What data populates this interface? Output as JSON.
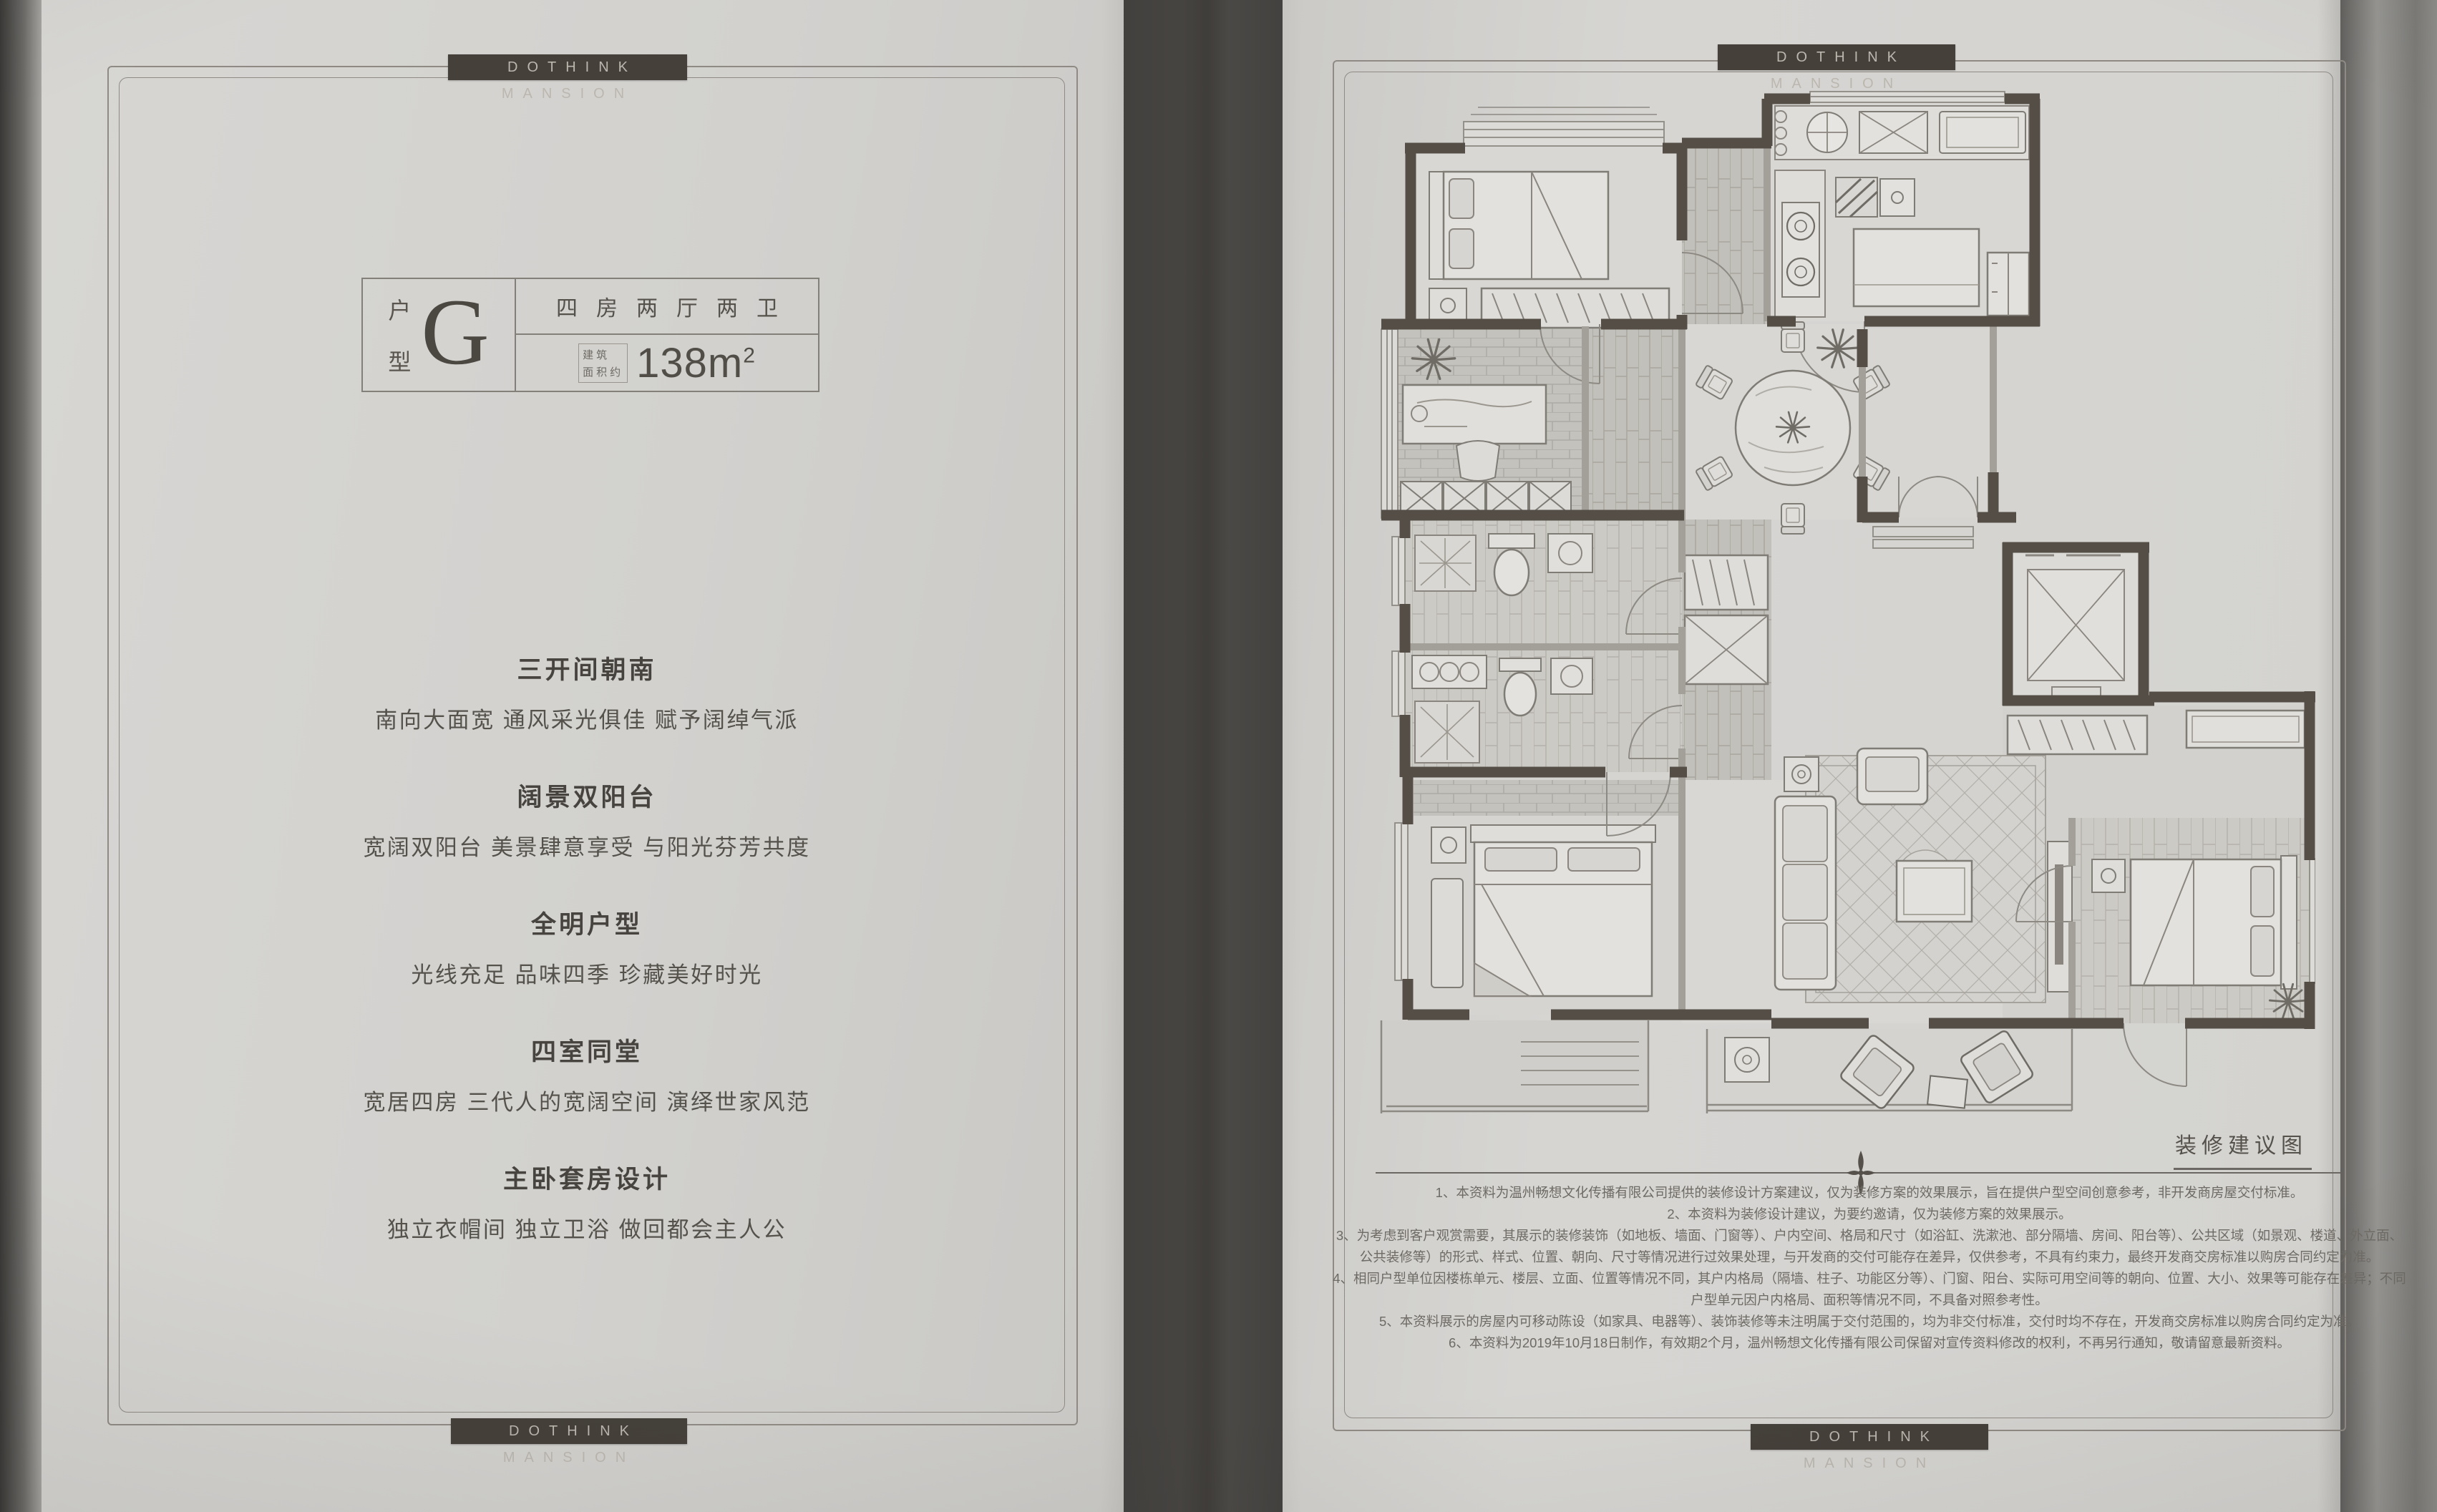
{
  "brand": "DOTHINK MANSION",
  "left_page": {
    "unit": {
      "label_top": "户",
      "label_bottom": "型",
      "letter": "G",
      "layout": "四房两厅两卫",
      "area_note_line1": "建筑",
      "area_note_line2": "面积约",
      "area_value": "138m",
      "area_sup": "2"
    },
    "features": [
      {
        "title": "三开间朝南",
        "desc": "南向大面宽 通风采光俱佳 赋予阔绰气派"
      },
      {
        "title": "阔景双阳台",
        "desc": "宽阔双阳台 美景肆意享受 与阳光芬芳共度"
      },
      {
        "title": "全明户型",
        "desc": "光线充足 品味四季 珍藏美好时光"
      },
      {
        "title": "四室同堂",
        "desc": "宽居四房 三代人的宽阔空间 演绎世家风范"
      },
      {
        "title": "主卧套房设计",
        "desc": "独立衣帽间 独立卫浴 做回都会主人公"
      }
    ]
  },
  "right_page": {
    "caption": "装修建议图",
    "disclaimers": [
      "1、本资料为温州畅想文化传播有限公司提供的装修设计方案建议，仅为装修方案的效果展示，旨在提供户型空间创意参考，非开发商房屋交付标准。",
      "2、本资料为装修设计建议，为要约邀请，仅为装修方案的效果展示。",
      "3、为考虑到客户观赏需要，其展示的装修装饰（如地板、墙面、门窗等）、户内空间、格局和尺寸（如浴缸、洗漱池、部分隔墙、房间、阳台等）、公共区域（如景观、楼道、外立面、公共装修等）的形式、样式、位置、朝向、尺寸等情况进行过效果处理，与开发商的交付可能存在差异，仅供参考，不具有约束力，最终开发商交房标准以购房合同约定为准。",
      "4、相同户型单位因楼栋单元、楼层、立面、位置等情况不同，其户内格局（隔墙、柱子、功能区分等）、门窗、阳台、实际可用空间等的朝向、位置、大小、效果等可能存在差异；不同户型单元因户内格局、面积等情况不同，不具备对照参考性。",
      "5、本资料展示的房屋内可移动陈设（如家具、电器等）、装饰装修等未注明属于交付范围的，均为非交付标准，交付时均不存在，开发商交房标准以购房合同约定为准。",
      "6、本资料为2019年10月18日制作，有效期2个月，温州畅想文化传播有限公司保留对宣传资料修改的权利，不再另行通知，敬请留意最新资料。"
    ]
  },
  "colors": {
    "paper": "#d5d4d1",
    "wall_dark": "#554e47",
    "bar": "#45403a",
    "frame": "#8f8b84"
  }
}
